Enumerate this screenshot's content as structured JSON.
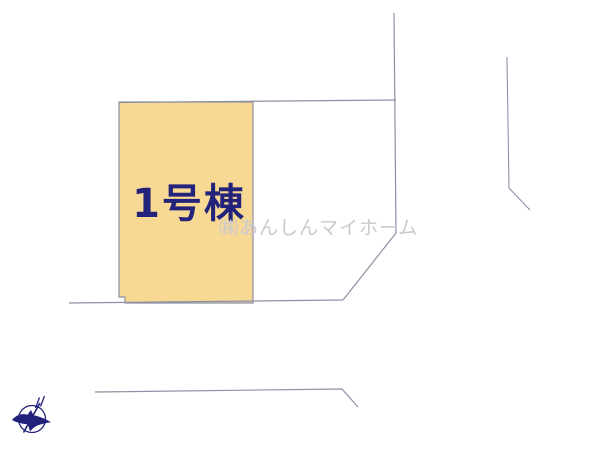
{
  "plan": {
    "parcel_label": "1号棟",
    "watermark_text": "㈱あんしんマイホーム"
  },
  "colors": {
    "background": "#ffffff",
    "parcel_fill": "#f8d993",
    "boundary_line": "#8e90a4",
    "label_text": "#23237c",
    "watermark": "#c9c9cf",
    "compass": "#22227a"
  },
  "icons": {
    "compass_icon": "compass-north-bird-icon"
  }
}
